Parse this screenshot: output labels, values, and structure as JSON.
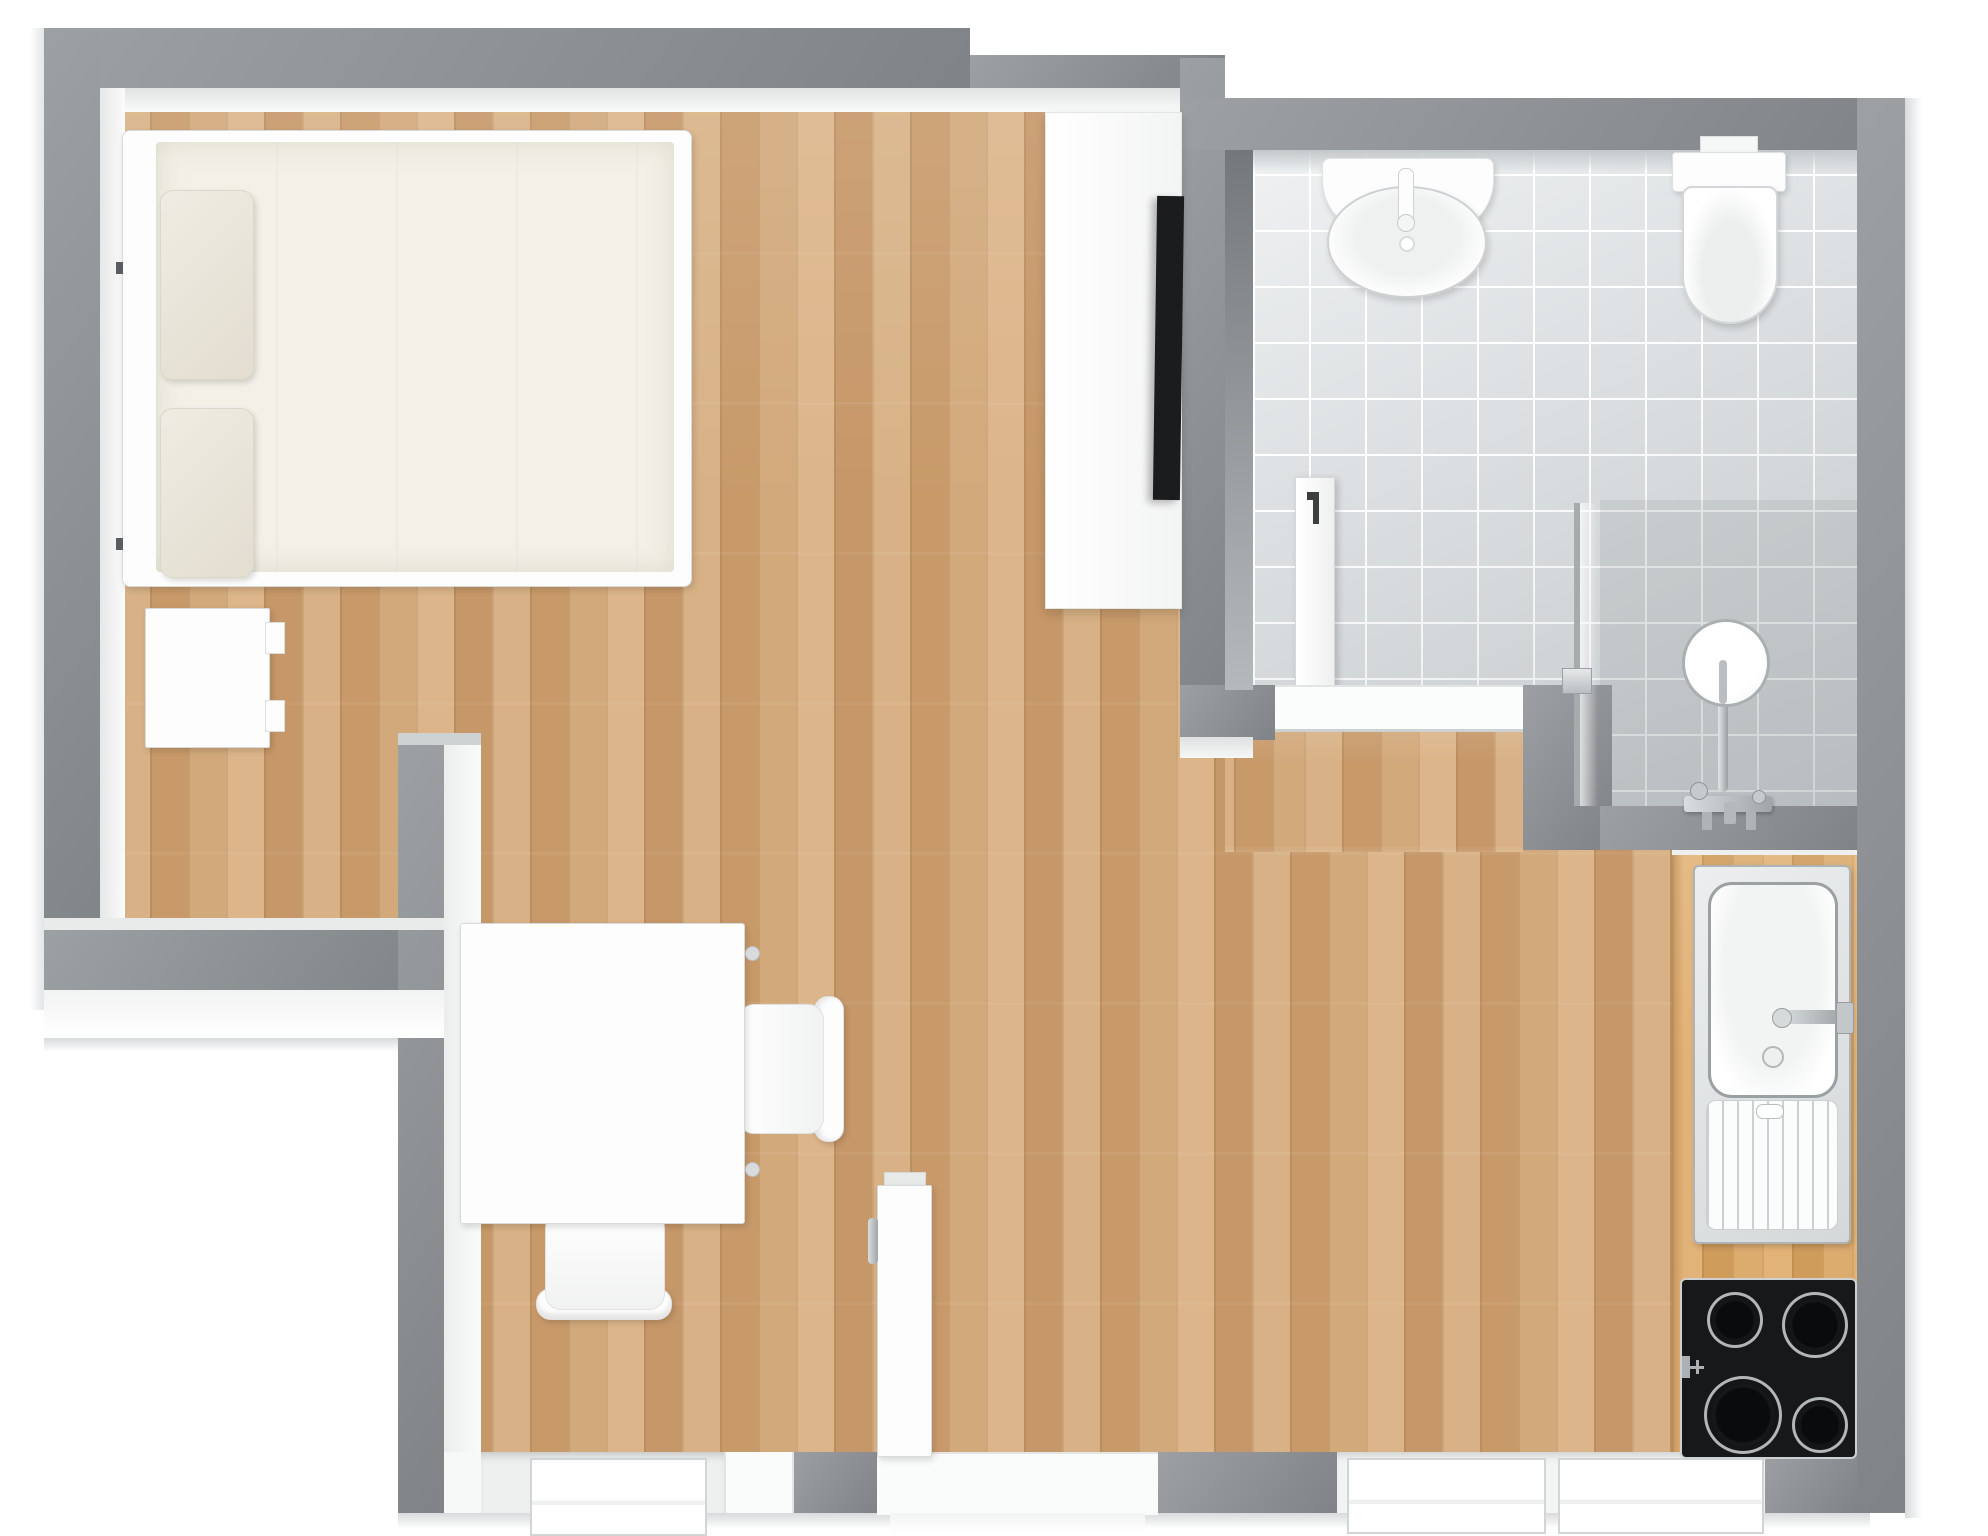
{
  "scene": {
    "label": "3D floor plan of a studio apartment, top-down view",
    "type": "floor-plan-render"
  },
  "palette": {
    "wall": "#8e9296",
    "face": "#f6f7f7",
    "outside": "#ffffff",
    "wood": "#cfa677",
    "counter": "#d7a766",
    "tile": "#dce0e2",
    "grout": "#ffffff",
    "fixture": "#fdfdfd",
    "fixture-edge": "#d8dadb",
    "chrome": "#b6bbbe",
    "appliance-black": "#17181a",
    "mattress": "#f2f0e7",
    "pillow": "#e9e5da"
  },
  "rooms": [
    {
      "id": "main-room",
      "label": "Main room (sleeping / living / dining)",
      "floor": "wood plank"
    },
    {
      "id": "bathroom",
      "label": "Bathroom",
      "floor": "grey ceramic tile"
    },
    {
      "id": "kitchenette",
      "label": "Kitchenette counter run",
      "floor": "butcher-block counter"
    }
  ],
  "furniture": {
    "bed": {
      "label": "Double bed with two pillows"
    },
    "pillow_top": {
      "label": "Pillow"
    },
    "pillow_bottom": {
      "label": "Pillow"
    },
    "nightstand": {
      "label": "Nightstand"
    },
    "tv_cabinet": {
      "label": "Sideboard / TV cabinet"
    },
    "tv": {
      "label": "Wall-mounted TV"
    },
    "table": {
      "label": "Table / desk"
    },
    "chair_side": {
      "label": "Chair"
    },
    "chair_front": {
      "label": "Chair"
    },
    "bath_sink": {
      "label": "Wash basin"
    },
    "toilet": {
      "label": "Wall-hung toilet"
    },
    "bath_door": {
      "label": "Bathroom door, standing open"
    },
    "shower_glass": {
      "label": "Shower glass partition"
    },
    "shower_head": {
      "label": "Rain shower head"
    },
    "shower_mixer": {
      "label": "Shower mixer tap"
    },
    "kitchen_sink": {
      "label": "Kitchen sink with drainboard"
    },
    "kitchen_faucet": {
      "label": "Kitchen faucet"
    },
    "cooktop": {
      "label": "4-zone black cooktop"
    },
    "entry_door": {
      "label": "Entrance door, standing open"
    },
    "window_left": {
      "label": "Window"
    },
    "window_right": {
      "label": "Double window"
    }
  }
}
